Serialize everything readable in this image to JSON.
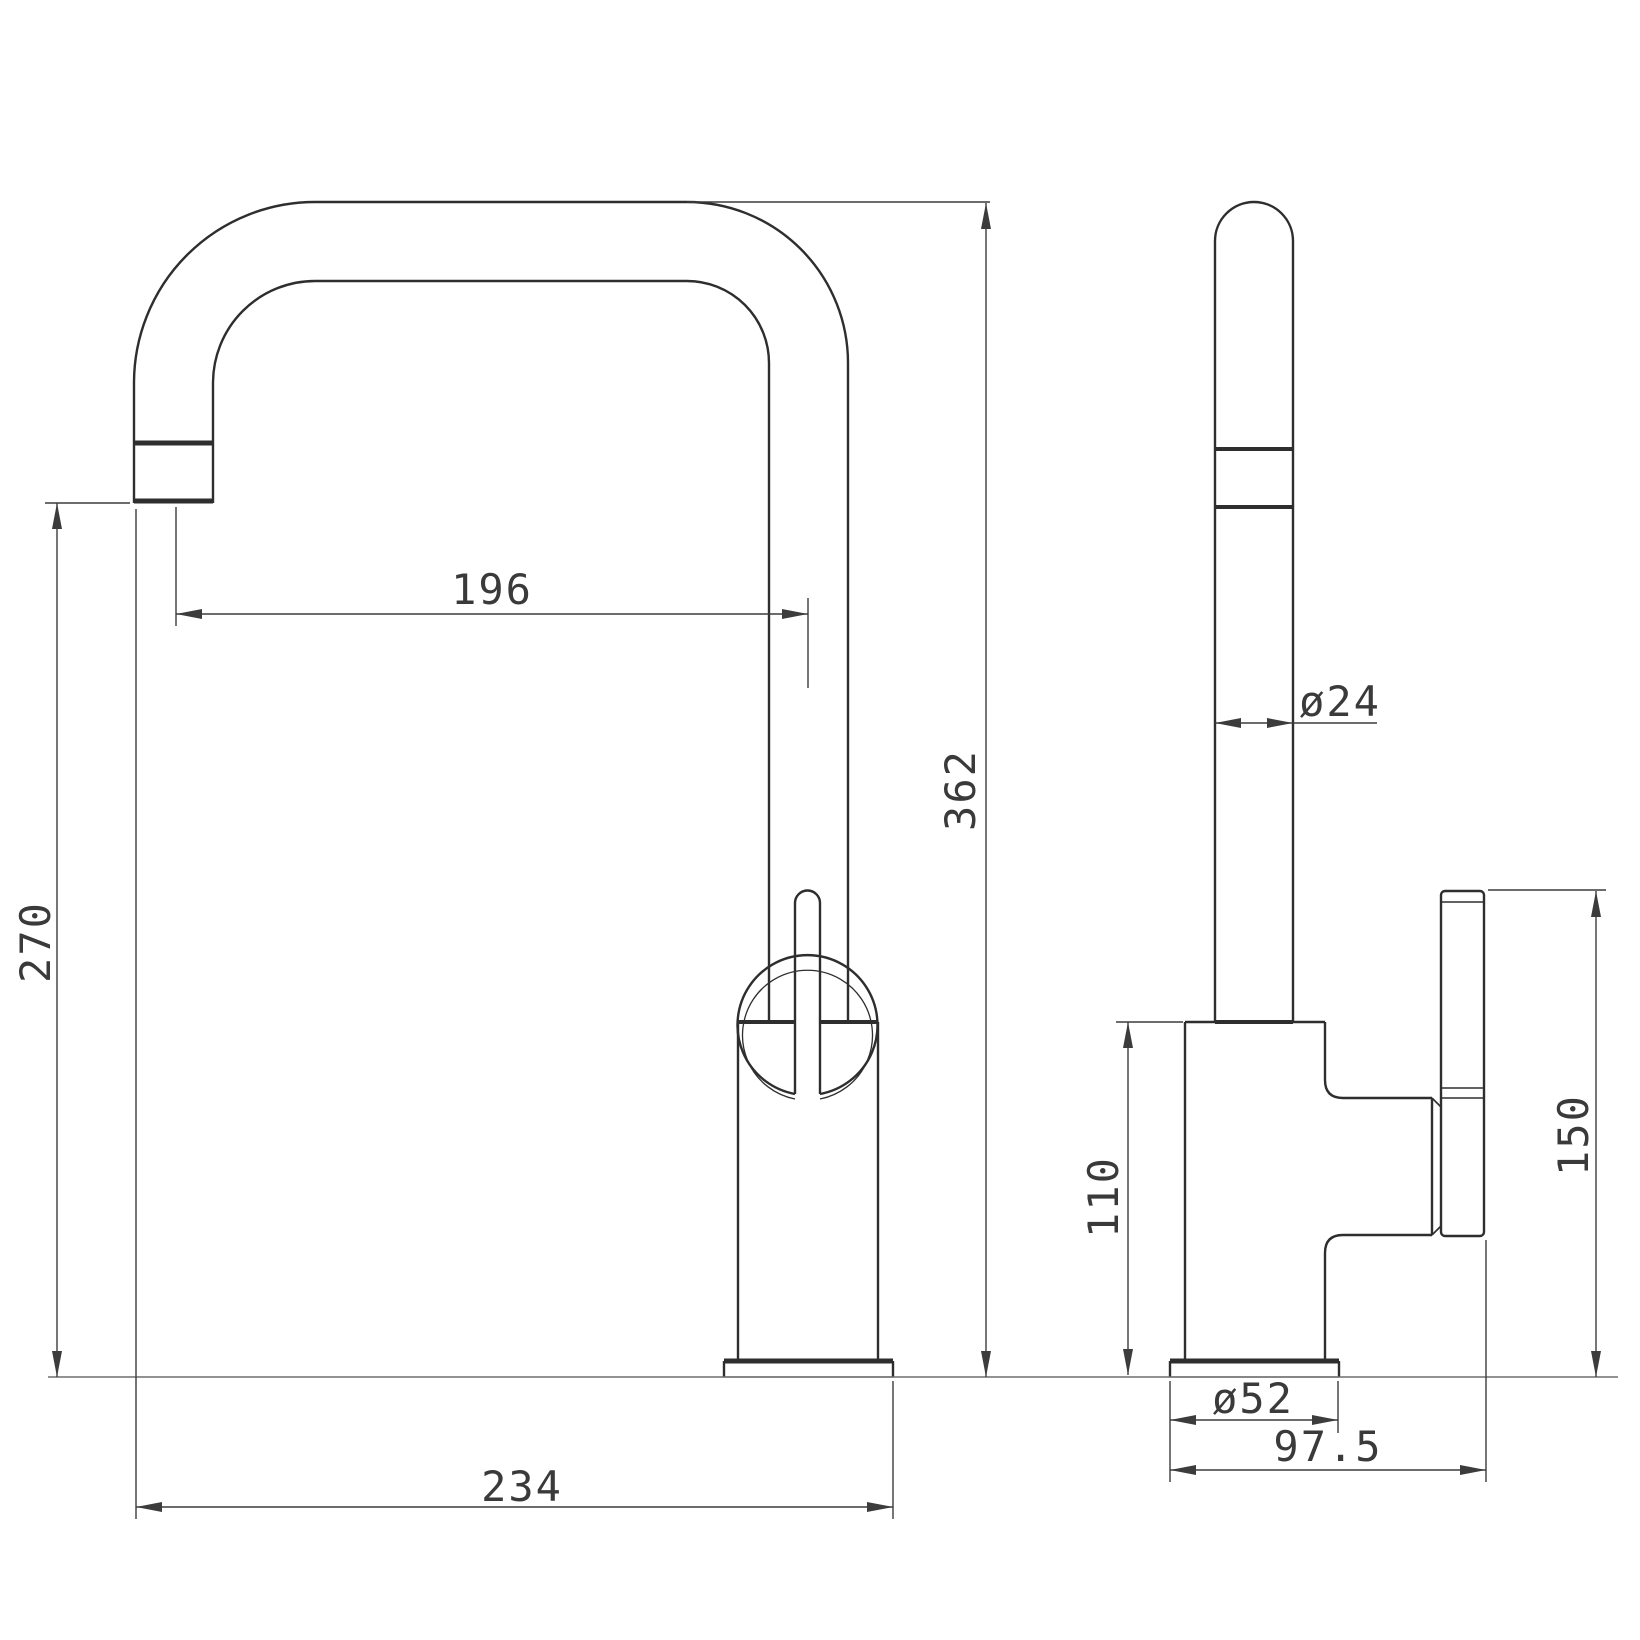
{
  "drawing": {
    "type": "technical-dimension-drawing",
    "subject": "kitchen mixer tap, front and side orthographic views",
    "colors": {
      "background": "#ffffff",
      "outline": "#2e2e2e",
      "dimension": "#3c3c3c",
      "ground_line": "#6f6f6f"
    },
    "views": {
      "front": "front view",
      "side": "side view"
    },
    "dimensions": {
      "spout_reach": "196",
      "overall_height": "362",
      "spout_clearance": "270",
      "overall_width": "234",
      "pipe_diameter": "ø24",
      "body_height": "110",
      "base_diameter": "ø52",
      "overall_depth": "97.5",
      "handle_height": "150"
    }
  }
}
